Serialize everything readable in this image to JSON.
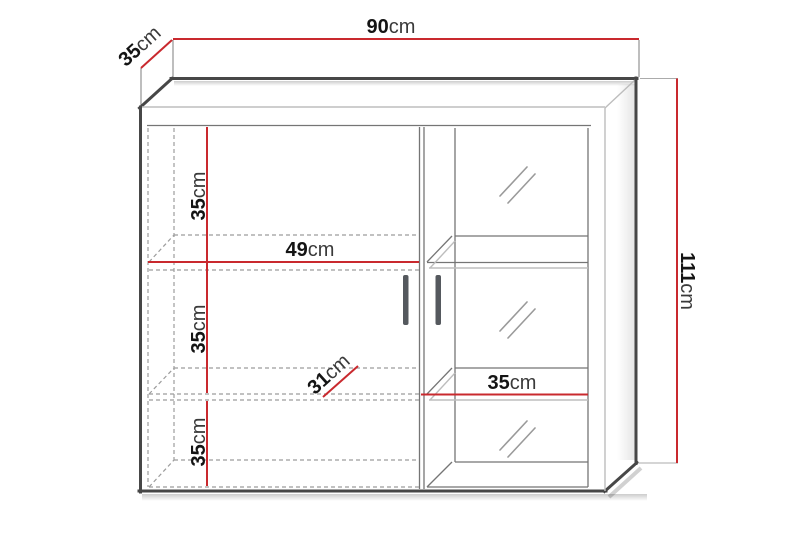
{
  "labels": {
    "overall_width": {
      "number": "90",
      "unit": "cm"
    },
    "overall_depth": {
      "number": "35",
      "unit": "cm"
    },
    "overall_height": {
      "number": "111",
      "unit": "cm"
    },
    "left_inner_width": {
      "number": "49",
      "unit": "cm"
    },
    "inner_depth": {
      "number": "31",
      "unit": "cm"
    },
    "left_shelf_1": {
      "number": "35",
      "unit": "cm"
    },
    "left_shelf_2": {
      "number": "35",
      "unit": "cm"
    },
    "left_shelf_3": {
      "number": "35",
      "unit": "cm"
    },
    "right_inner_width": {
      "number": "35",
      "unit": "cm"
    }
  },
  "colors": {
    "dimension-red": "#c9292e",
    "outline-dark": "#474747",
    "line-mid": "#757575",
    "line-light": "#bdbdbd",
    "line-dash": "#9c9c9c",
    "handle": "#55595e",
    "text-dark": "#141414",
    "unit-gray": "#3a3a3a",
    "background": "#ffffff"
  }
}
